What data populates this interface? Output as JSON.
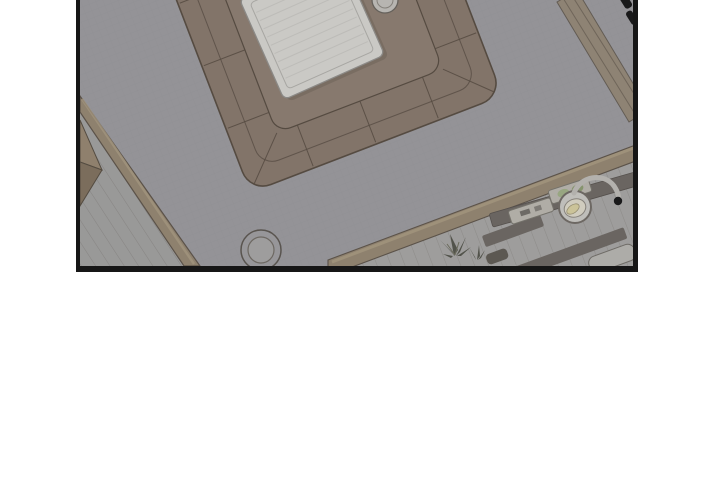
{
  "page": {
    "background": "#ffffff"
  },
  "panel": {
    "type": "comic-panel",
    "scene": "overhead view of a living room with sectional sofa, coffee table and kitchen strip",
    "border_color": "#161616",
    "colors": {
      "floor": "#98979a",
      "floor_line": "#8d8c8f",
      "sofa": "#85766a",
      "sofa_line": "#564b40",
      "rug": "#8b7c6f",
      "table": "#d1d0cb",
      "table_line": "#a3a19c",
      "table_slat": "#c3c2bd",
      "wall": "#92846f",
      "wall_light": "#a6987f",
      "wall_dark": "#5c5348",
      "hallway": "#9e9d9b",
      "hallway_line": "#8a8986",
      "kitchen": "#a3a2a0",
      "kitchen_line": "#918f8b",
      "counter": "#6c6761",
      "tray": "#b6b3aa",
      "tray_line": "#77746c",
      "green_a": "#9cab83",
      "green_b": "#89986f",
      "sink": "#c6c4bf",
      "sink_line": "#6f6a64",
      "sink_inner": "#d7d3c3",
      "lemon": "#d2ca9c",
      "metal": "#b9b7b2",
      "black_item": "#171717",
      "plant": "#53544a",
      "appliance": "#b3b1ac",
      "furniture_left_top": "#93836e",
      "furniture_left_bottom": "#7e6f5c",
      "stool_line": "#5a554e"
    }
  }
}
